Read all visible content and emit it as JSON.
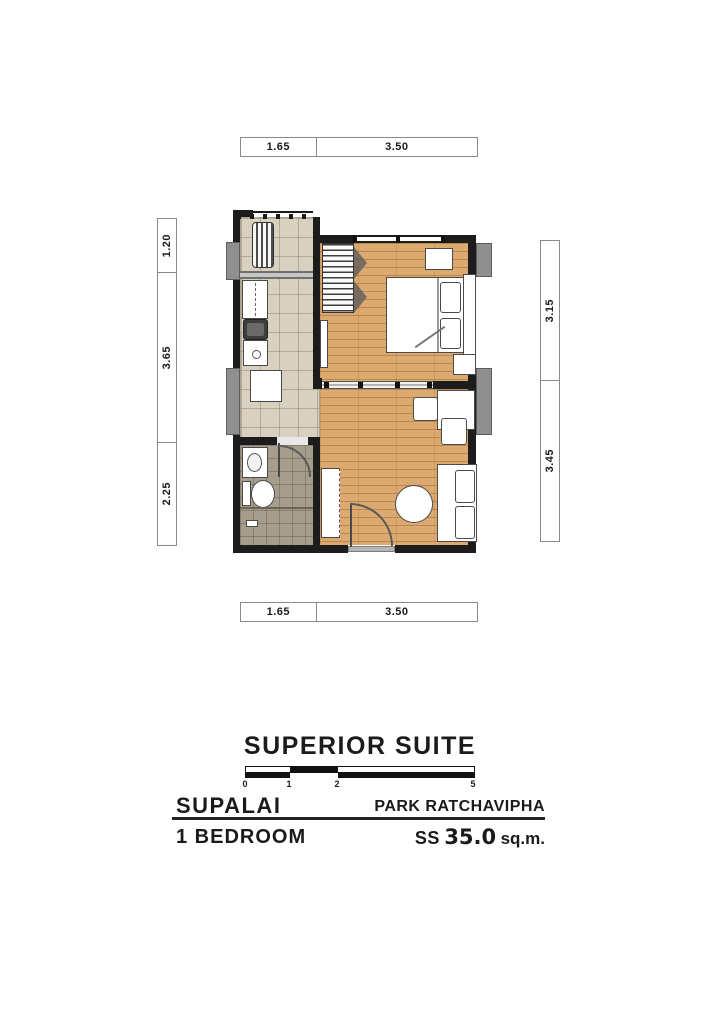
{
  "header": {
    "plan_name": "SUPERIOR SUITE"
  },
  "footer": {
    "brand": "SUPALAI",
    "project": "PARK RATCHAVIPHA",
    "unit_type": "1 BEDROOM",
    "area_code": "SS",
    "area_value": "35.0",
    "area_unit": "sq.m."
  },
  "scale_bar": {
    "tick_labels": [
      "0",
      "1",
      "2",
      "5"
    ]
  },
  "dimensions": {
    "top": [
      "1.65",
      "3.50"
    ],
    "bottom": [
      "1.65",
      "3.50"
    ],
    "left": [
      "1.20",
      "3.65",
      "2.25"
    ],
    "right": [
      "3.15",
      "3.45"
    ]
  },
  "furniture_icons": [
    "ac-condenser-unit",
    "refrigerator",
    "stove",
    "kitchen-sink",
    "kitchen-table",
    "wardrobe",
    "bed",
    "pillows",
    "nightstand",
    "wall-tv",
    "desk",
    "chair",
    "round-table",
    "sofa",
    "tv-cabinet",
    "washbasin",
    "toilet",
    "floor-drain",
    "door-swing",
    "sliding-door",
    "window"
  ],
  "colors": {
    "wall": "#1c1c1c",
    "wood_floor": "#dca970",
    "tile_floor": "#d9d1bf",
    "bath_floor": "#a69d8d",
    "column_gray": "#8f8f8f"
  }
}
